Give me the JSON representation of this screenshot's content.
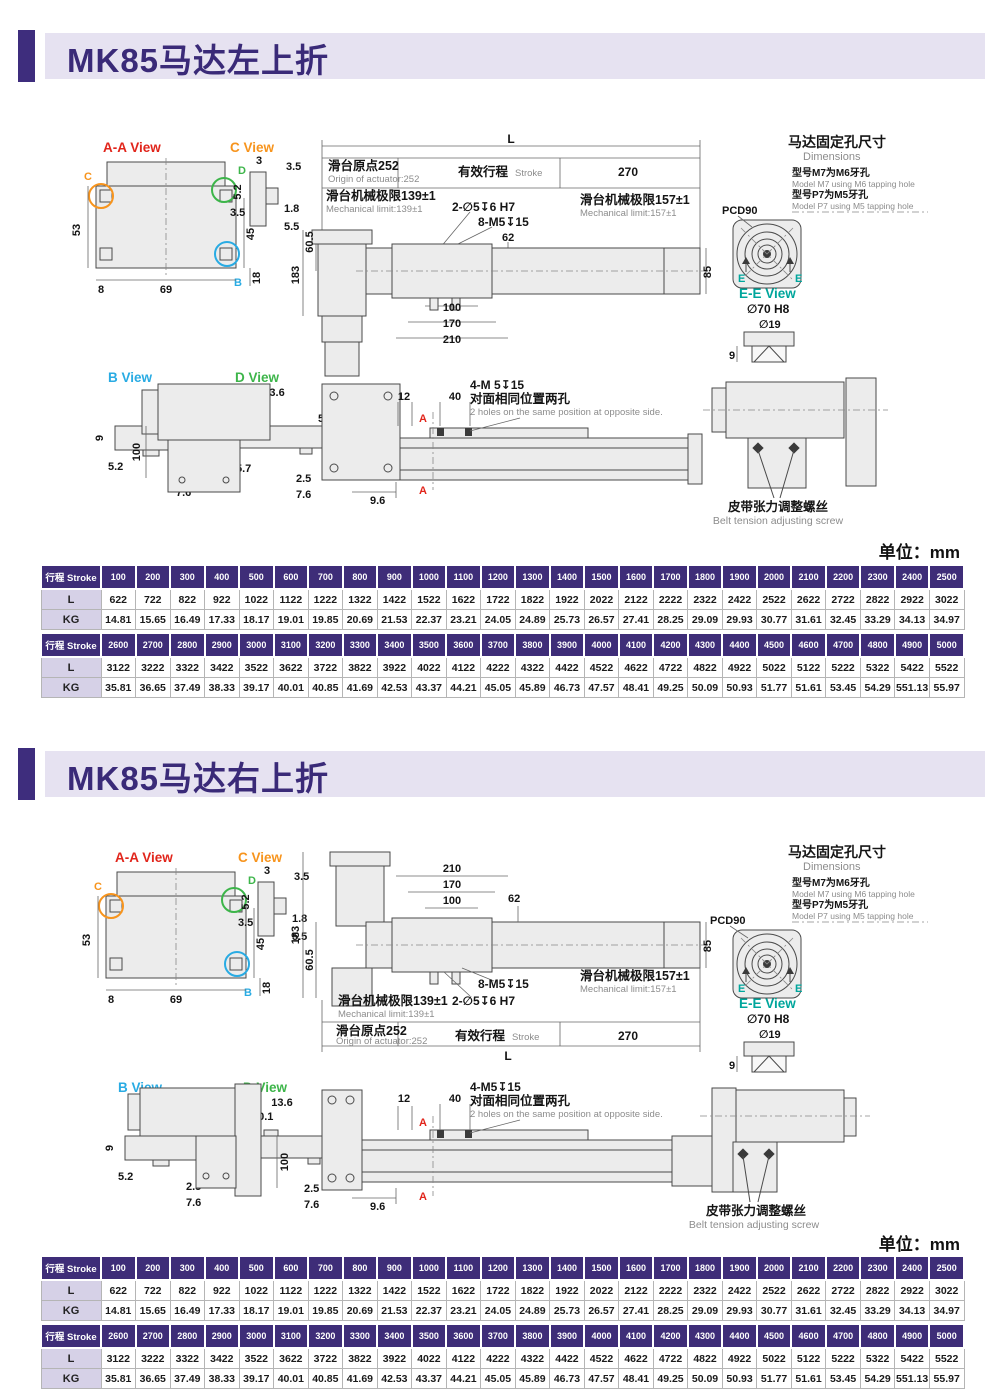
{
  "unit_label": "单位：mm",
  "sections": [
    {
      "title": "MK85马达左上折"
    },
    {
      "title": "MK85马达右上折"
    }
  ],
  "views": {
    "aa_label": "A-A View",
    "c_label": "C View",
    "b_label": "B View",
    "d_label": "D View",
    "marker_c": "C",
    "marker_d": "D",
    "marker_b": "B",
    "aa": {
      "h": "53",
      "inner": "45",
      "left": "8",
      "bottom": "69",
      "right": "18"
    },
    "c": {
      "top": "3",
      "topright": "3.5",
      "left": "5.2",
      "midleft": "3.5",
      "right": "1.8",
      "bottom": "5.5"
    },
    "b": {
      "top": "8.5",
      "right": "5.2",
      "left": "9",
      "bottomleft": "5.2",
      "slot": "2.5",
      "bottom": "7.6"
    },
    "d": {
      "top": "13.6",
      "top2": "10.1",
      "right": "5.2",
      "left": "6.7",
      "bottomleft": "5.7",
      "height": "9",
      "slot": "2.5",
      "bottom": "7.6"
    }
  },
  "assembly": {
    "l": "L",
    "origin_cn": "滑台原点252",
    "origin_en": "Origin of actuator:252",
    "stroke_cn": "有效行程",
    "stroke_en": "Stroke",
    "travel_right": "270",
    "limit139_cn": "滑台机械极限139±1",
    "limit139_en": "Mechanical limit:139±1",
    "limit157_cn": "滑台机械极限157±1",
    "limit157_en": "Mechanical limit:157±1",
    "holes_pin": "2-∅5↧6 H7",
    "holes_tap": "8-M5↧15",
    "d62": "62",
    "d183": "183",
    "d60_5": "60.5",
    "d85": "85",
    "d100": "100",
    "d170": "170",
    "d210": "210"
  },
  "motor_panel": {
    "title_cn": "马达固定孔尺寸",
    "title_en": "Dimensions",
    "m7_cn": "型号M7为M6牙孔",
    "m7_en": "Model M7 using M6 tapping hole",
    "p7_cn": "型号P7为M5牙孔",
    "p7_en": "Model P7 using M5 tapping hole",
    "pcd": "PCD90",
    "e": "E",
    "ee_label": "E-E View",
    "d70": "∅70 H8",
    "d19": "∅19",
    "d9": "9"
  },
  "plan": {
    "holes_label_a": "4-M 5↧15",
    "holes_label_b": "4-M5↧15",
    "holes_cn": "对面相同位置两孔",
    "holes_en": "2 holes on the same position at opposite side.",
    "d12": "12",
    "d40": "40",
    "d9_6": "9.6",
    "d100": "100",
    "a_marker": "A",
    "belt_cn": "皮带张力调整螺丝",
    "belt_en": "Belt tension adjusting screw"
  },
  "tables": {
    "stroke_header": "行程 Stroke",
    "blocks": [
      {
        "strokes": [
          "100",
          "200",
          "300",
          "400",
          "500",
          "600",
          "700",
          "800",
          "900",
          "1000",
          "1100",
          "1200",
          "1300",
          "1400",
          "1500",
          "1600",
          "1700",
          "1800",
          "1900",
          "2000",
          "2100",
          "2200",
          "2300",
          "2400",
          "2500"
        ],
        "rows": [
          {
            "label": "L",
            "values": [
              "622",
              "722",
              "822",
              "922",
              "1022",
              "1122",
              "1222",
              "1322",
              "1422",
              "1522",
              "1622",
              "1722",
              "1822",
              "1922",
              "2022",
              "2122",
              "2222",
              "2322",
              "2422",
              "2522",
              "2622",
              "2722",
              "2822",
              "2922",
              "3022"
            ]
          },
          {
            "label": "KG",
            "values": [
              "14.81",
              "15.65",
              "16.49",
              "17.33",
              "18.17",
              "19.01",
              "19.85",
              "20.69",
              "21.53",
              "22.37",
              "23.21",
              "24.05",
              "24.89",
              "25.73",
              "26.57",
              "27.41",
              "28.25",
              "29.09",
              "29.93",
              "30.77",
              "31.61",
              "32.45",
              "33.29",
              "34.13",
              "34.97"
            ]
          }
        ]
      },
      {
        "strokes": [
          "2600",
          "2700",
          "2800",
          "2900",
          "3000",
          "3100",
          "3200",
          "3300",
          "3400",
          "3500",
          "3600",
          "3700",
          "3800",
          "3900",
          "4000",
          "4100",
          "4200",
          "4300",
          "4400",
          "4500",
          "4600",
          "4700",
          "4800",
          "4900",
          "5000"
        ],
        "rows": [
          {
            "label": "L",
            "values": [
              "3122",
              "3222",
              "3322",
              "3422",
              "3522",
              "3622",
              "3722",
              "3822",
              "3922",
              "4022",
              "4122",
              "4222",
              "4322",
              "4422",
              "4522",
              "4622",
              "4722",
              "4822",
              "4922",
              "5022",
              "5122",
              "5222",
              "5322",
              "5422",
              "5522"
            ]
          },
          {
            "label": "KG",
            "values": [
              "35.81",
              "36.65",
              "37.49",
              "38.33",
              "39.17",
              "40.01",
              "40.85",
              "41.69",
              "42.53",
              "43.37",
              "44.21",
              "45.05",
              "45.89",
              "46.73",
              "47.57",
              "48.41",
              "49.25",
              "50.09",
              "50.93",
              "51.77",
              "51.61",
              "53.45",
              "54.29",
              "551.13",
              "55.97"
            ]
          }
        ]
      }
    ]
  },
  "colors": {
    "accent_purple": "#3e2d7d",
    "band_purple": "#e6e2f1",
    "table_header": "#3e2d78",
    "label_cell": "#d6d1e7",
    "view_red": "#e1251b",
    "view_orange": "#f7941d",
    "view_blue": "#29abe3",
    "view_green": "#3db54a",
    "view_teal": "#00a69c",
    "marker_red": "#e1251b"
  }
}
